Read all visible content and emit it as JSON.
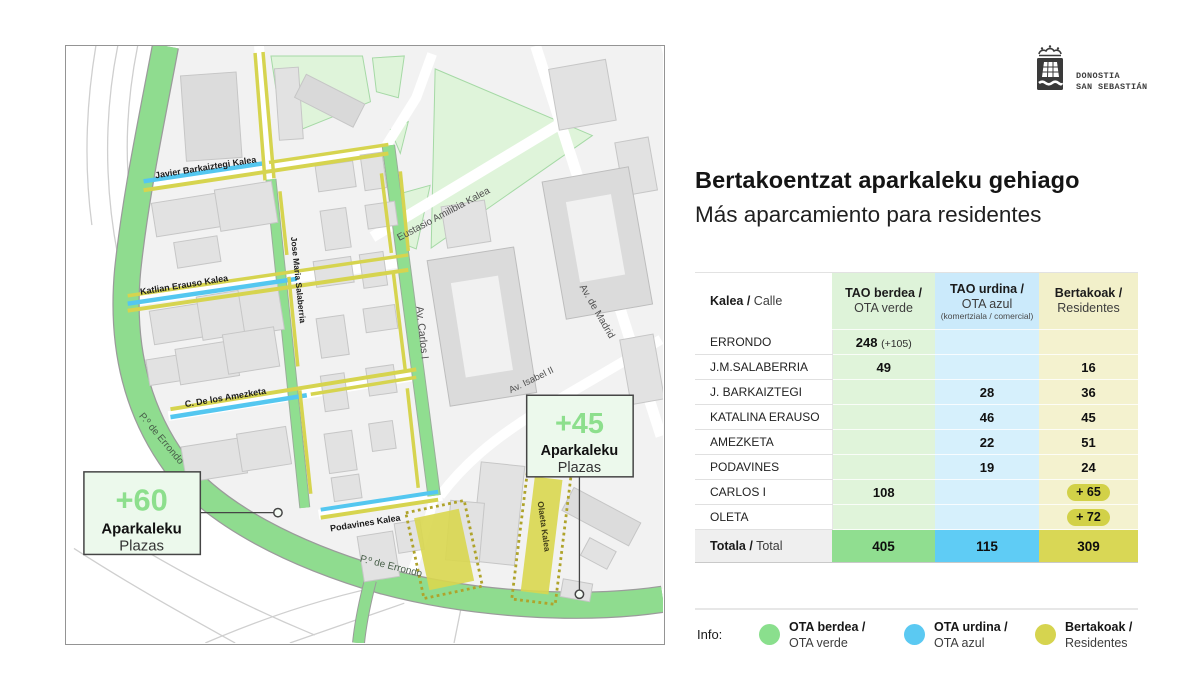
{
  "logo": {
    "city_line1": "DONOSTIA",
    "city_line2": "SAN SEBASTIÁN"
  },
  "header": {
    "title_eu": "Bertakoentzat aparkaleku gehiago",
    "title_es": "Más aparcamiento para residentes"
  },
  "table": {
    "header": {
      "col0_bold": "Kalea /",
      "col0_light": "Calle",
      "col1_bold": "TAO berdea /",
      "col1_light": "OTA verde",
      "col2_bold": "TAO urdina /",
      "col2_light": "OTA azul",
      "col2_note": "(komertziala / comercial)",
      "col3_bold": "Bertakoak /",
      "col3_light": "Residentes"
    },
    "rows": [
      {
        "name": "ERRONDO",
        "green": "248",
        "green_note": "(+105)",
        "blue": "",
        "yellow": ""
      },
      {
        "name": "J.M.SALABERRIA",
        "green": "49",
        "green_note": "",
        "blue": "",
        "yellow": "16"
      },
      {
        "name": "J. BARKAIZTEGI",
        "green": "",
        "green_note": "",
        "blue": "28",
        "yellow": "36"
      },
      {
        "name": "KATALINA ERAUSO",
        "green": "",
        "green_note": "",
        "blue": "46",
        "yellow": "45"
      },
      {
        "name": "AMEZKETA",
        "green": "",
        "green_note": "",
        "blue": "22",
        "yellow": "51"
      },
      {
        "name": "PODAVINES",
        "green": "",
        "green_note": "",
        "blue": "19",
        "yellow": "24"
      },
      {
        "name": "CARLOS I",
        "green": "108",
        "green_note": "",
        "blue": "",
        "yellow": "+ 65"
      },
      {
        "name": "OLETA",
        "green": "",
        "green_note": "",
        "blue": "",
        "yellow": "+ 72"
      }
    ],
    "total": {
      "bold": "Totala /",
      "light": "Total",
      "green": "405",
      "blue": "115",
      "yellow": "309"
    }
  },
  "legend": {
    "label": "Info:",
    "items": [
      {
        "bold": "OTA berdea /",
        "light": "OTA verde"
      },
      {
        "bold": "OTA urdina /",
        "light": "OTA azul"
      },
      {
        "bold": "Bertakoak /",
        "light": "Residentes"
      }
    ]
  },
  "map": {
    "labels": {
      "javier": "Javier Barkaiztegi Kalea",
      "katlian": "Katlian Erauso Kalea",
      "amezketa": "C. De los Amezketa",
      "salaberria": "Jose Maria Salaberria",
      "carlos": "Av. Carlos I",
      "eustasio": "Eustasio Amilibia Kalea",
      "madrid": "Av. de Madrid",
      "isabel": "Av. Isabel II",
      "podavines": "Podavines Kalea",
      "olaeta": "Olaeta Kalea",
      "errondo1": "P.º de Errondo",
      "errondo2": "P.º de Errondo"
    },
    "badges": [
      {
        "value": "+60",
        "word1": "Aparkaleku",
        "word2": "Plazas"
      },
      {
        "value": "+45",
        "word1": "Aparkaleku",
        "word2": "Plazas"
      }
    ]
  },
  "colors": {
    "ota_green": "#8adf8d",
    "ota_blue": "#5bc9f2",
    "residents_yellow": "#d6d44f",
    "park_green": "#dff4da",
    "building_gray": "#e2e2e2",
    "total_green": "#90de90",
    "total_blue": "#5fccf5",
    "total_yellow": "#d9d755"
  },
  "chart_data": {
    "type": "table",
    "title": "Bertakoentzat aparkaleku gehiago / Más aparcamiento para residentes",
    "columns": [
      "Kalea / Calle",
      "TAO berdea / OTA verde",
      "TAO urdina / OTA azul (komertziala / comercial)",
      "Bertakoak / Residentes"
    ],
    "rows": [
      [
        "ERRONDO",
        "248 (+105)",
        "",
        ""
      ],
      [
        "J.M.SALABERRIA",
        "49",
        "",
        "16"
      ],
      [
        "J. BARKAIZTEGI",
        "",
        "28",
        "36"
      ],
      [
        "KATALINA ERAUSO",
        "",
        "46",
        "45"
      ],
      [
        "AMEZKETA",
        "",
        "22",
        "51"
      ],
      [
        "PODAVINES",
        "",
        "19",
        "24"
      ],
      [
        "CARLOS I",
        "108",
        "",
        "+ 65"
      ],
      [
        "OLETA",
        "",
        "",
        "+ 72"
      ],
      [
        "Totala / Total",
        "405",
        "115",
        "309"
      ]
    ],
    "map_annotations": [
      "+60 Aparkaleku Plazas",
      "+45 Aparkaleku Plazas"
    ]
  }
}
